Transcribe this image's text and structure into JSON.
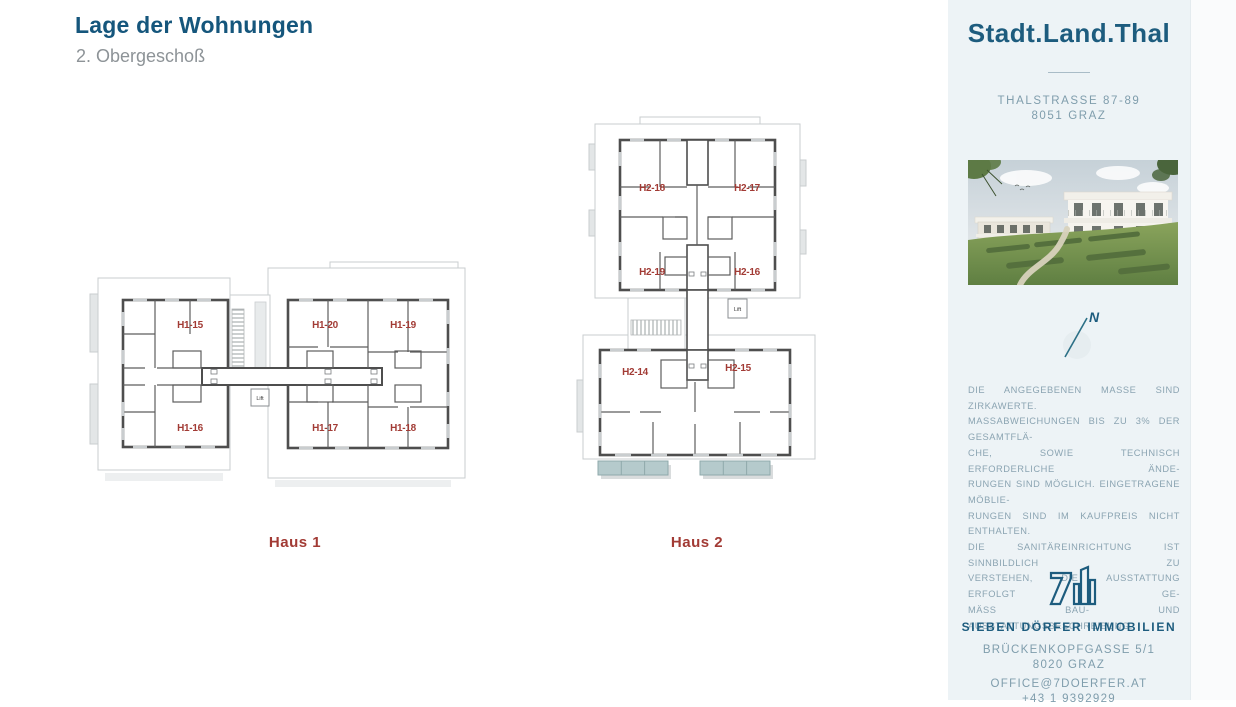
{
  "page": {
    "title": "Lage der Wohnungen",
    "subtitle": "2. Obergeschoß"
  },
  "plans": {
    "lift_label": "Lift",
    "haus1": {
      "name": "Haus 1",
      "units": [
        "H1-15",
        "H1-20",
        "H1-19",
        "H1-16",
        "H1-17",
        "H1-18"
      ]
    },
    "haus2": {
      "name": "Haus 2",
      "units": [
        "H2-18",
        "H2-17",
        "H2-19",
        "H2-16",
        "H2-14",
        "H2-15"
      ]
    }
  },
  "sidebar": {
    "brand": "Stadt.Land.Thal",
    "address_line1": "THALSTRASSE 87-89",
    "address_line2": "8051 GRAZ",
    "compass_label": "N",
    "disclaimer_lines": [
      "DIE ANGEGEBENEN MASSE SIND ZIRKAWERTE.",
      "MASSABWEICHUNGEN BIS ZU 3% DER GESAMTFLÄ-",
      "CHE, SOWIE TECHNISCH ERFORDERLICHE ÄNDE-",
      "RUNGEN SIND MÖGLICH. EINGETRAGENE MÖBLIE-",
      "RUNGEN SIND IM KAUFPREIS NICHT ENTHALTEN.",
      "DIE SANITÄREINRICHTUNG IST SINNBILDLICH ZU",
      "VERSTEHEN, DIE AUSSTATTUNG ERFOLGT GE-",
      "MÄSS BAU- UND AUSSTATTUNGSBESCHREIBUNG."
    ],
    "company": "SIEBEN DÖRFER IMMOBILIEN",
    "company_address_line1": "BRÜCKENKOPFGASSE 5/1",
    "company_address_line2": "8020 GRAZ",
    "email": "OFFICE@7DOERFER.AT",
    "phone": "+43 1 9392929"
  },
  "colors": {
    "brand_teal": "#1d5c7e",
    "title_teal": "#15567c",
    "unit_label_red": "#a23b35",
    "sidebar_bg": "#edf3f6",
    "muted_text_blue": "#7f9dac",
    "wall_gray": "#4e4e4e",
    "balcony_teal": "#b5cacc"
  }
}
